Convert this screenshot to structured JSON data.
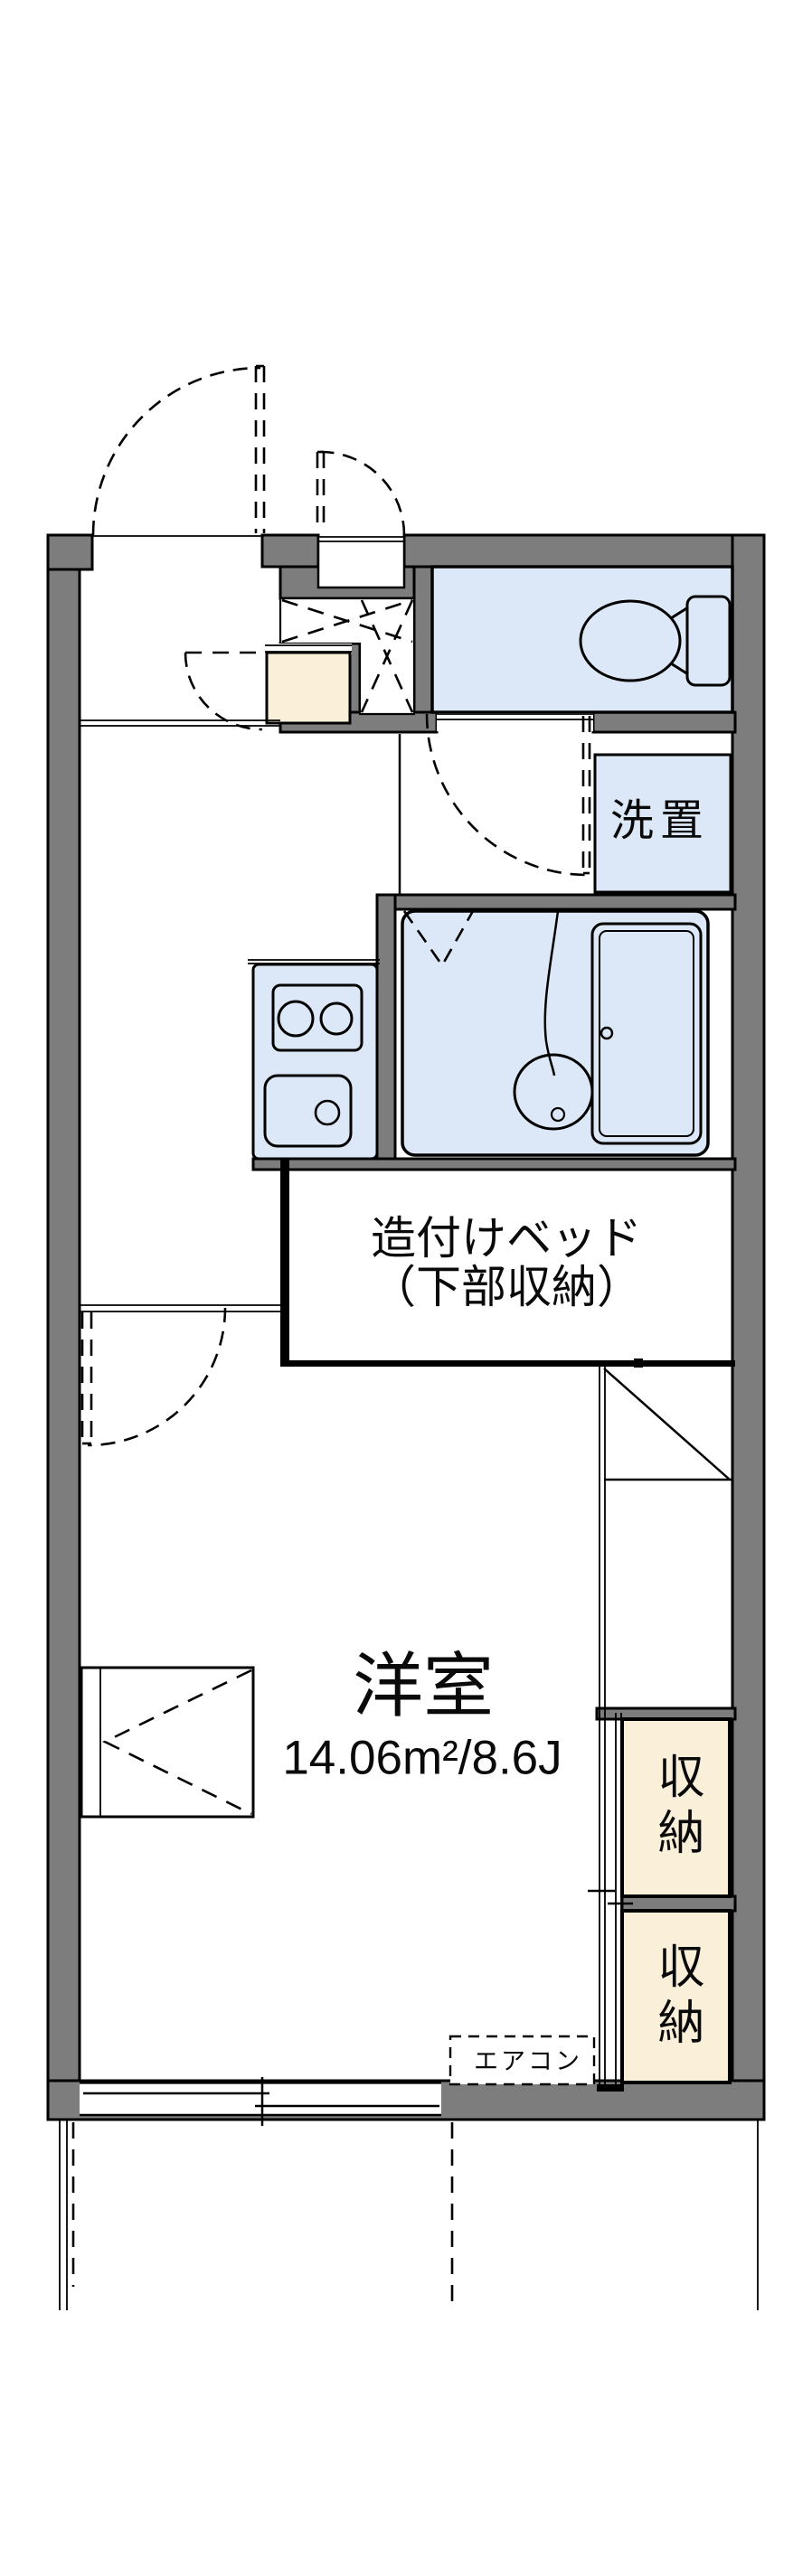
{
  "colors": {
    "wall_gray": "#7d7d7d",
    "water_blue": "#dce8f7",
    "storage_cream": "#faf0da",
    "line_black": "#000000",
    "floor_white": "#ffffff"
  },
  "labels": {
    "washstand": "洗置",
    "bed_line1": "造付けベッド",
    "bed_line2": "（下部収納）",
    "room_name": "洋室",
    "room_area": "14.06m²/8.6J",
    "storage_upper": "収納",
    "storage_lower": "収納",
    "aircon": "エアコン"
  }
}
